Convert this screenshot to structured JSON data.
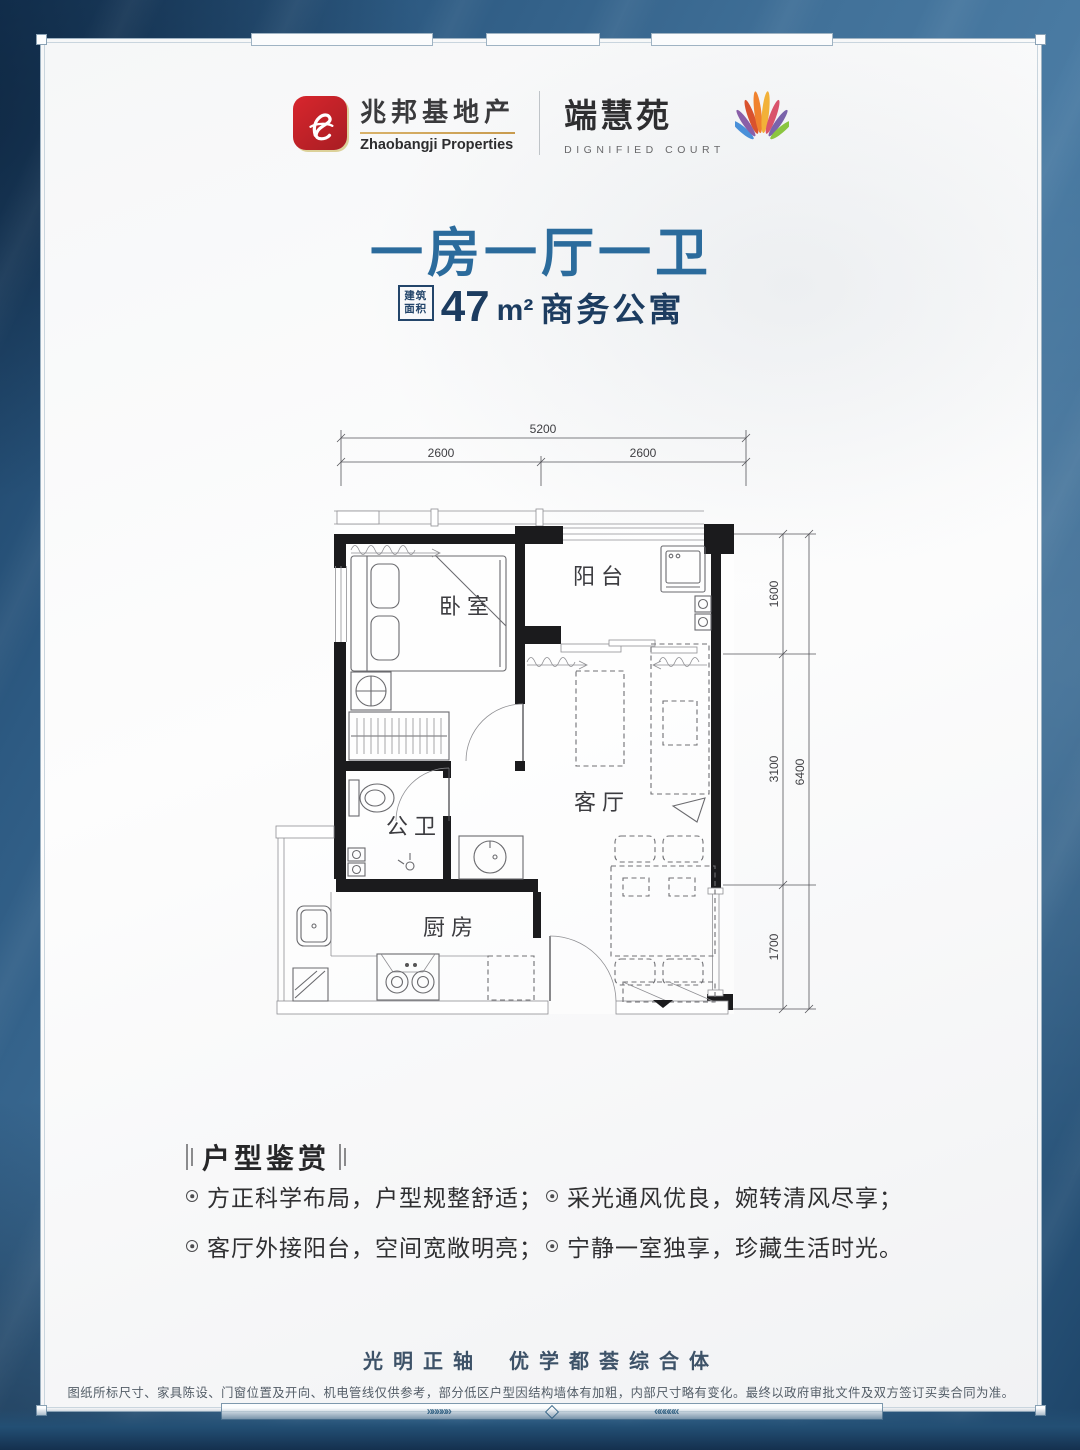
{
  "header": {
    "logo_zhaobangji": {
      "name_cn": "兆邦基地产",
      "name_en": "Zhaobangji Properties"
    },
    "logo_duanhuiyuan": {
      "name_cn": "端慧苑",
      "name_en": "DIGNIFIED COURT"
    }
  },
  "hero": {
    "title": "一房一厅一卫",
    "badge_line1": "建筑",
    "badge_line2": "面积",
    "area_number": "47",
    "area_unit": "m²",
    "area_suffix": "商务公寓"
  },
  "floorplan": {
    "rooms": {
      "bedroom": "卧室",
      "balcony": "阳台",
      "bathroom": "公卫",
      "living": "客厅",
      "kitchen": "厨房"
    },
    "dims": {
      "top_total": "5200",
      "top_left": "2600",
      "top_right": "2600",
      "right_seg1": "1600",
      "right_seg2": "3100",
      "right_seg3": "1700",
      "right_total": "6400"
    }
  },
  "features": {
    "heading": "户型鉴赏",
    "items": [
      "方正科学布局，户型规整舒适；",
      "客厅外接阳台，空间宽敞明亮；",
      "采光通风优良，婉转清风尽享；",
      "宁静一室独享，珍藏生活时光。"
    ]
  },
  "footer": {
    "slogan_part1": "光明正轴",
    "slogan_part2": "优学都荟综合体",
    "disclaimer": "图纸所标尺寸、家具陈设、门窗位置及开向、机电管线仅供参考，部分低区户型因结构墙体有加粗，内部尺寸略有变化。最终以政府审批文件及双方签订买卖合同为准。",
    "band": {
      "chevrons_right": "»»»»»",
      "chevrons_left": "«««««"
    }
  }
}
